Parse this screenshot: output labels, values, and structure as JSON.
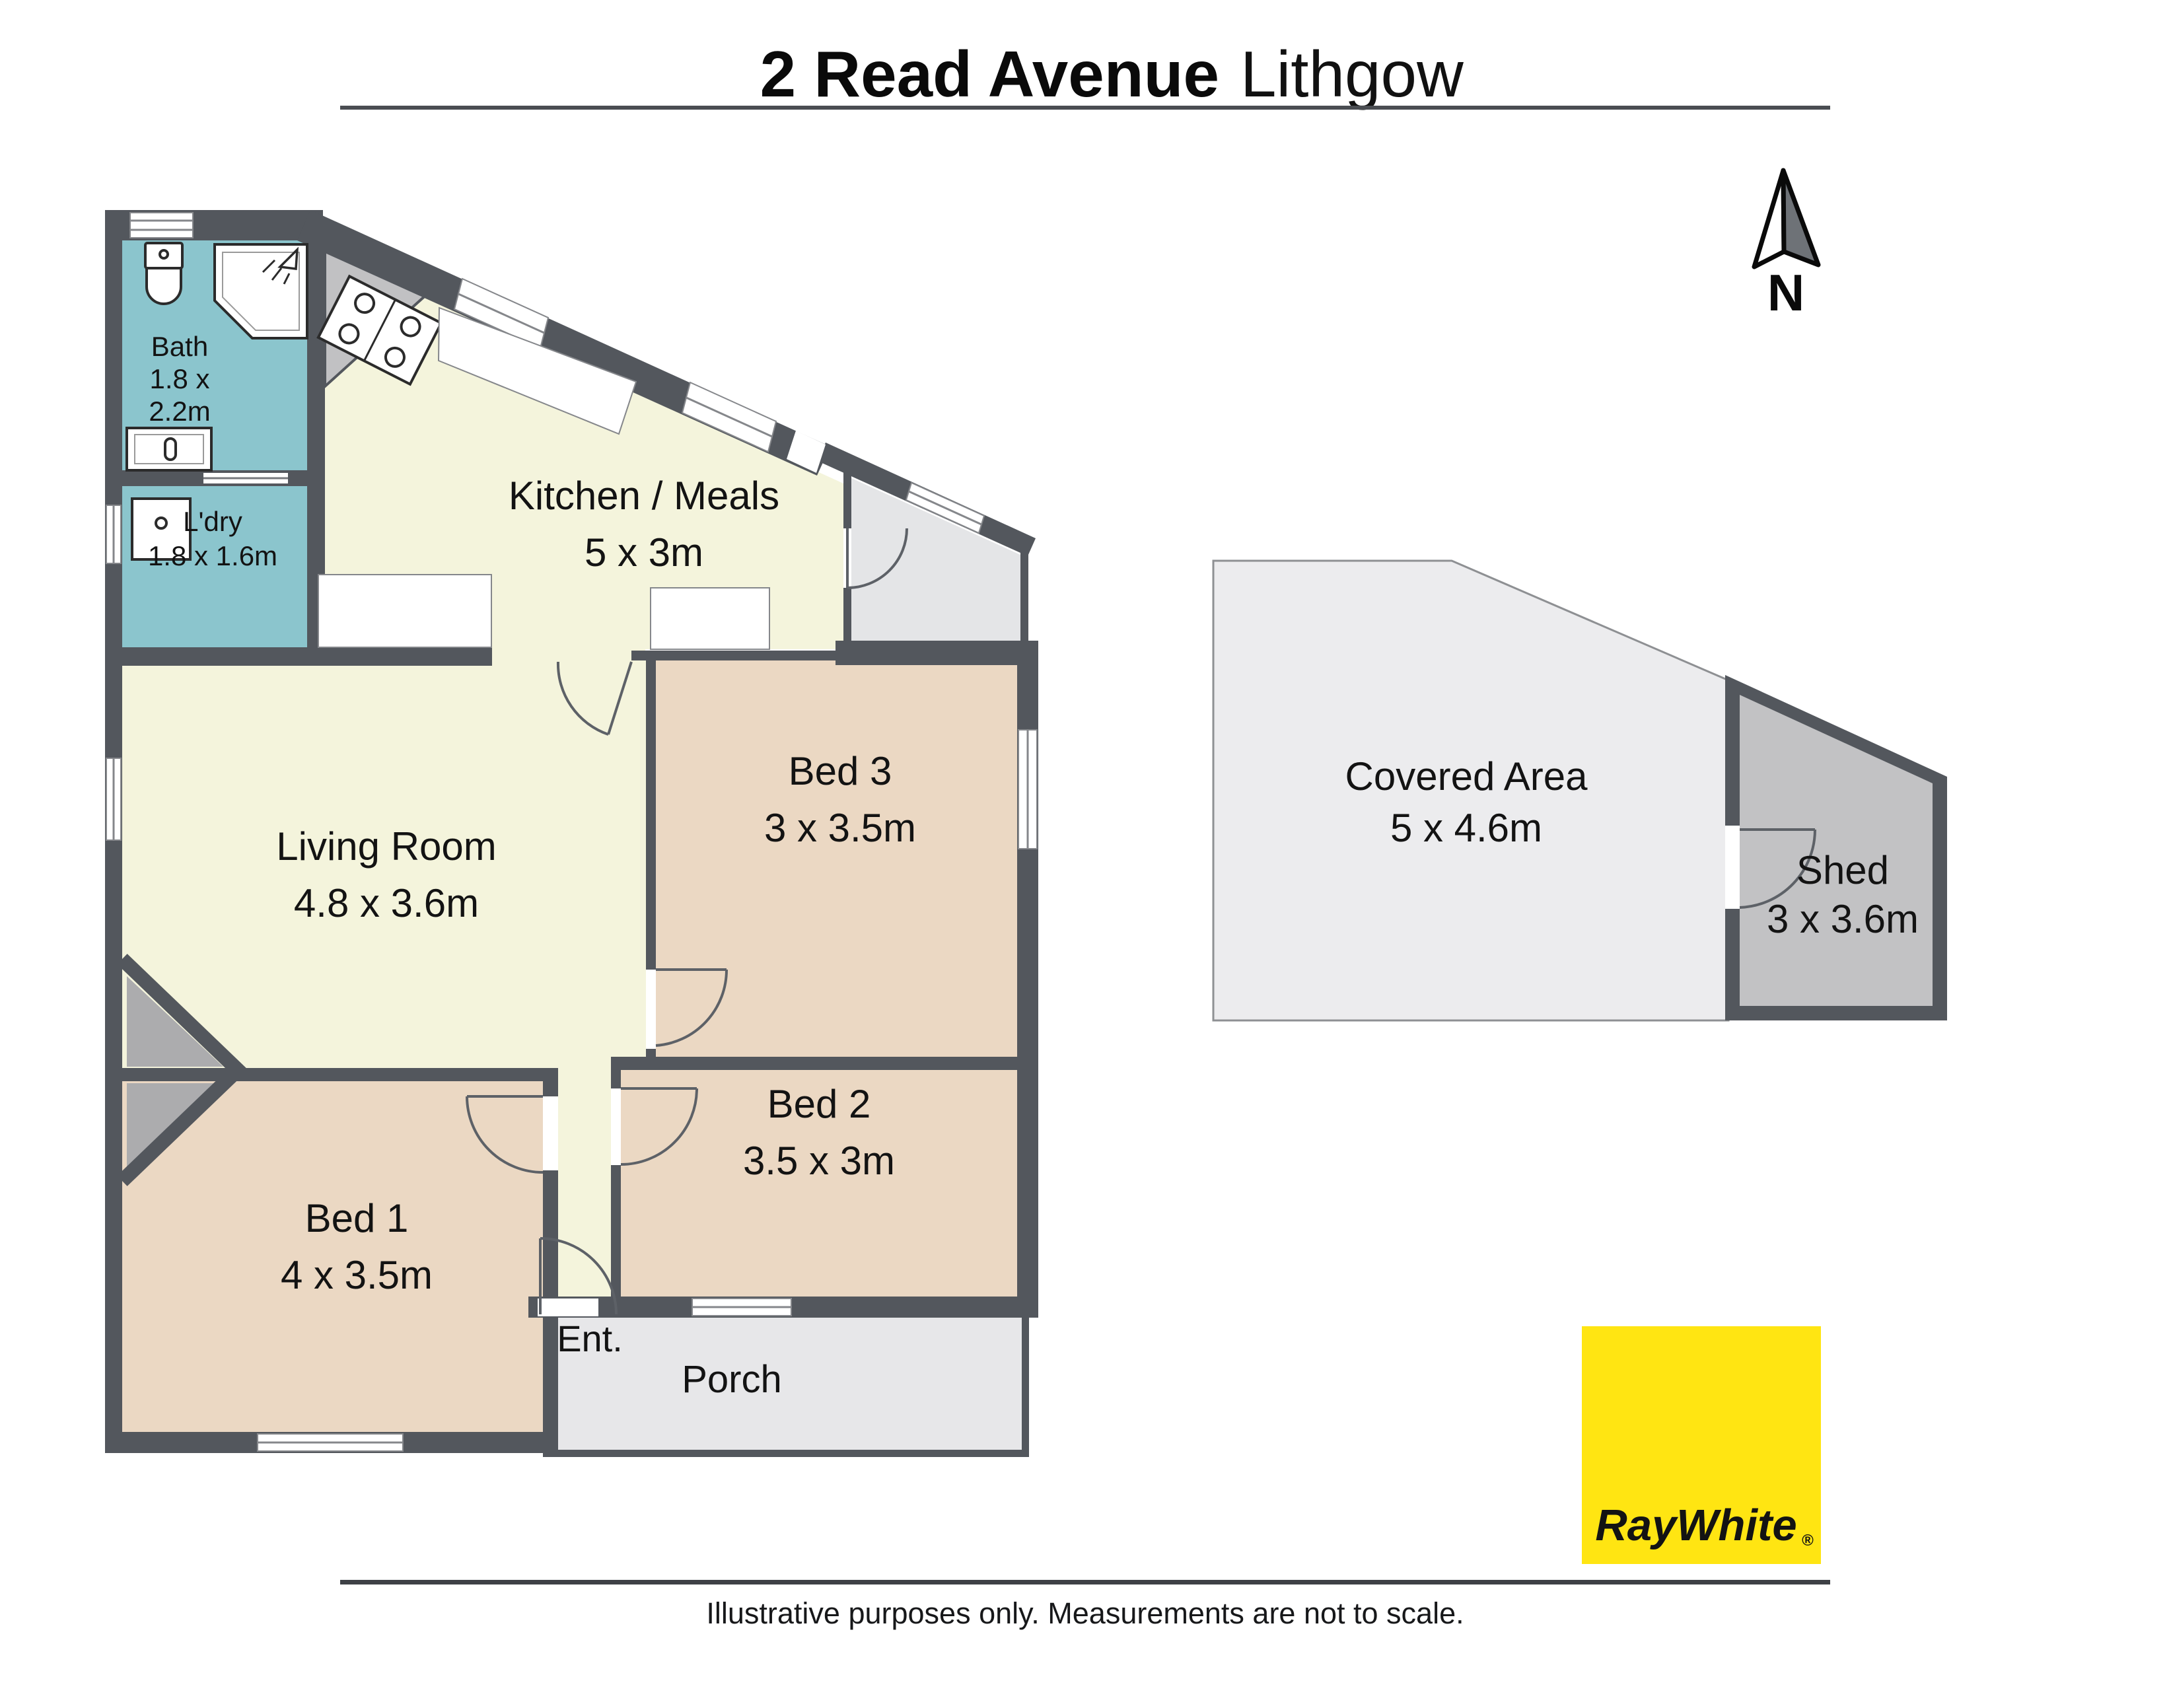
{
  "header": {
    "title_bold": "2 Read Avenue",
    "title_light": "Lithgow"
  },
  "compass": {
    "label": "N"
  },
  "rooms": {
    "bath": {
      "name": "Bath",
      "dims_line1": "1.8 x",
      "dims_line2": "2.2m"
    },
    "laundry": {
      "name": "L'dry",
      "dims": "1.8 x 1.6m"
    },
    "kitchen": {
      "name": "Kitchen / Meals",
      "dims": "5 x 3m"
    },
    "living": {
      "name": "Living Room",
      "dims": "4.8 x 3.6m"
    },
    "bed3": {
      "name": "Bed 3",
      "dims": "3 x 3.5m"
    },
    "bed2": {
      "name": "Bed 2",
      "dims": "3.5 x 3m"
    },
    "bed1": {
      "name": "Bed 1",
      "dims": "4 x 3.5m"
    },
    "entry": {
      "name": "Ent."
    },
    "porch": {
      "name": "Porch"
    },
    "covered_area": {
      "name": "Covered Area",
      "dims": "5 x 4.6m"
    },
    "shed": {
      "name": "Shed",
      "dims": "3 x 3.6m"
    }
  },
  "fixtures": {
    "toilet": "toilet",
    "shower": "shower",
    "vanity": "vanity basin",
    "washing_machine": "washing machine",
    "stove": "stove / cooktop"
  },
  "branding": {
    "logo_text": "RayWhite",
    "registered_mark": "®"
  },
  "footer": {
    "disclaimer": "Illustrative purposes only. Measurements are not to scale."
  },
  "colors": {
    "wall": "#53575D",
    "floor_wet": "#8BC5CD",
    "floor_living": "#F4F4DC",
    "floor_bedroom": "#EBD8C3",
    "floor_porch": "#E7E7E9",
    "floor_side_entry": "#E4E5E7",
    "floor_covered": "#ECECEE",
    "floor_shed": "#C2C2C4",
    "corner_gray": "#C1C1C3",
    "chimney_gray": "#ACACAE",
    "logo_yellow": "#FFE512",
    "logo_gray": "#585C63"
  }
}
